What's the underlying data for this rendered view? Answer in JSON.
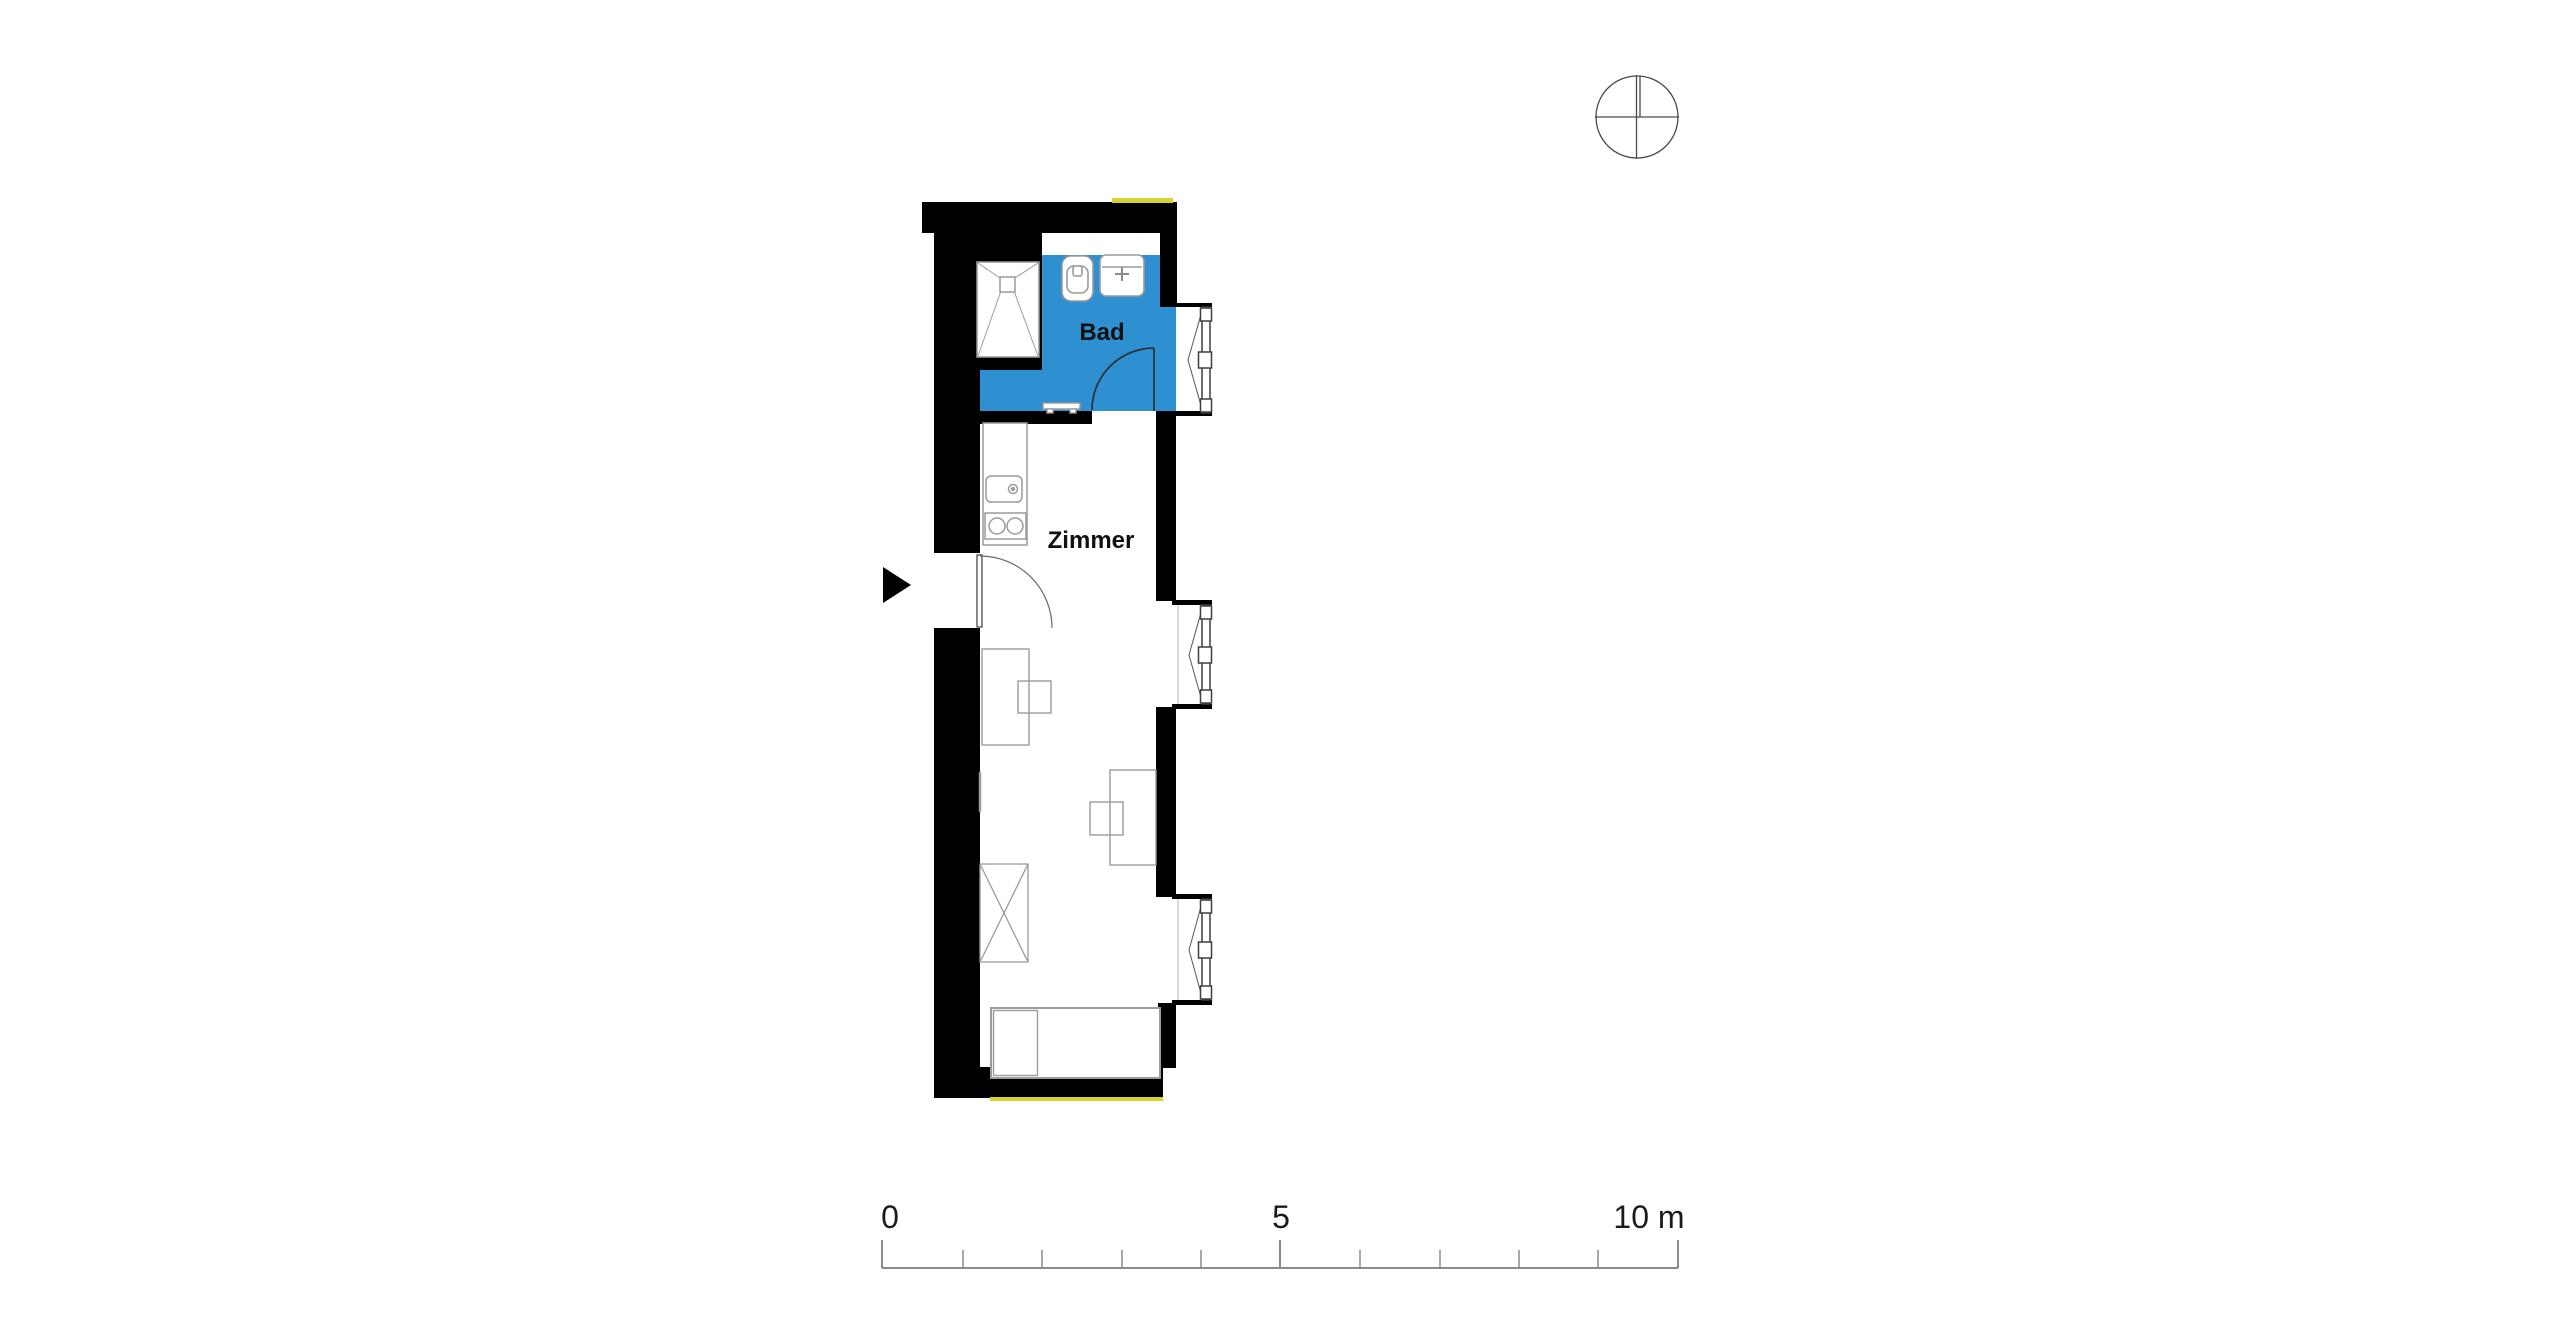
{
  "plan": {
    "rooms": [
      {
        "name": "Bad",
        "type": "bathroom",
        "floor_color": "#2e8fd1"
      },
      {
        "name": "Zimmer",
        "type": "room",
        "floor_color": "#ffffff"
      }
    ],
    "fixtures": [
      "shower",
      "toilet",
      "washbasin",
      "towel-radiator",
      "kitchenette-sink",
      "kitchenette-stove",
      "desk",
      "chair",
      "wardrobe",
      "bed"
    ],
    "windows_count": 3,
    "doors": [
      "entry-door",
      "bathroom-door"
    ],
    "symbols": [
      "entry-arrow",
      "north-compass"
    ]
  },
  "labels": {
    "bathroom": "Bad",
    "room": "Zimmer"
  },
  "scale_bar": {
    "tick_0": "0",
    "tick_5": "5",
    "tick_10": "10 m"
  },
  "colors": {
    "bath-blue": "#2e8fd1",
    "wall-black": "#000000",
    "accent-yellow": "#d8d22e",
    "furniture-gray": "#9b9b9b",
    "line-dark": "#4a4a4a",
    "scale-gray": "#8a8a8a"
  }
}
